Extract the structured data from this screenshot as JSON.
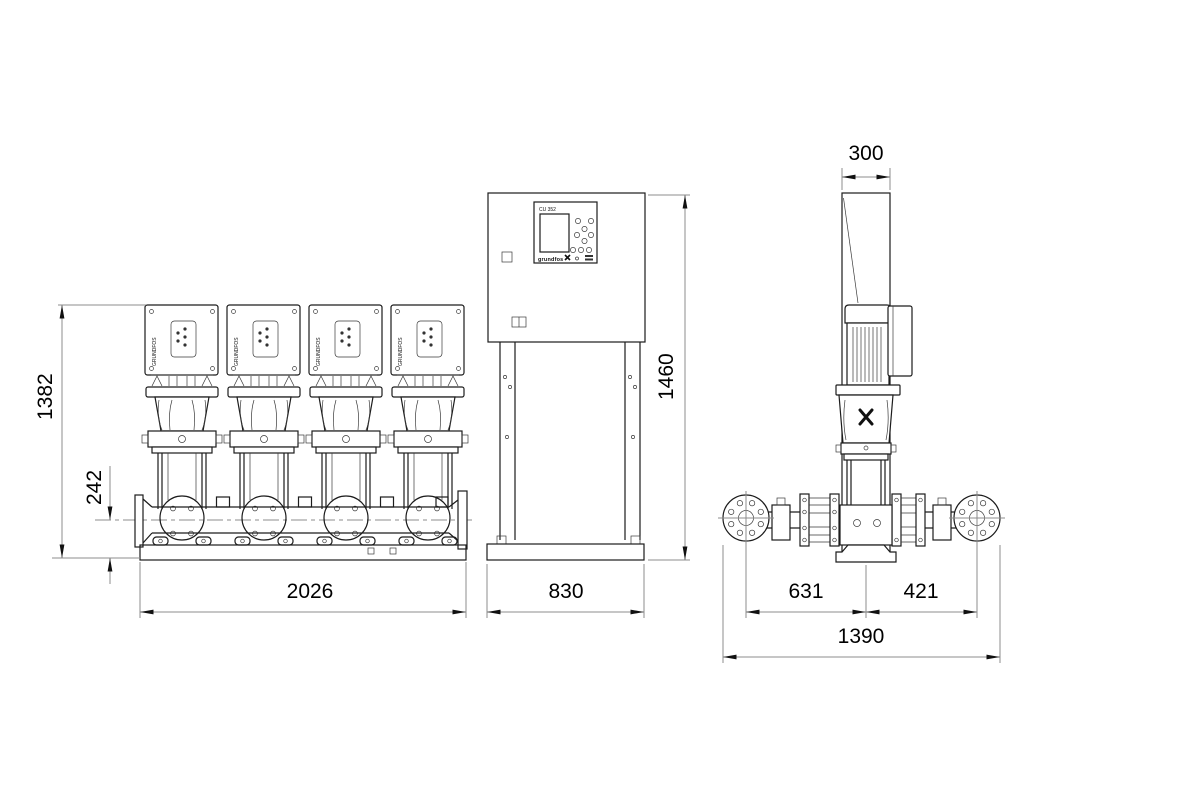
{
  "labels": {
    "controller": "CU 352",
    "brand_wordmark": "grundfos",
    "pump_brand": "GRUNDFOS"
  },
  "dimensions": {
    "front": {
      "total_height": "1382",
      "manifold_center_height": "242",
      "base_length": "2026",
      "cabinet_width": "830",
      "cabinet_height": "1460"
    },
    "side": {
      "cabinet_depth": "300",
      "inlet_to_pump_center": "631",
      "pump_center_to_outlet": "421",
      "total_depth": "1390"
    }
  }
}
